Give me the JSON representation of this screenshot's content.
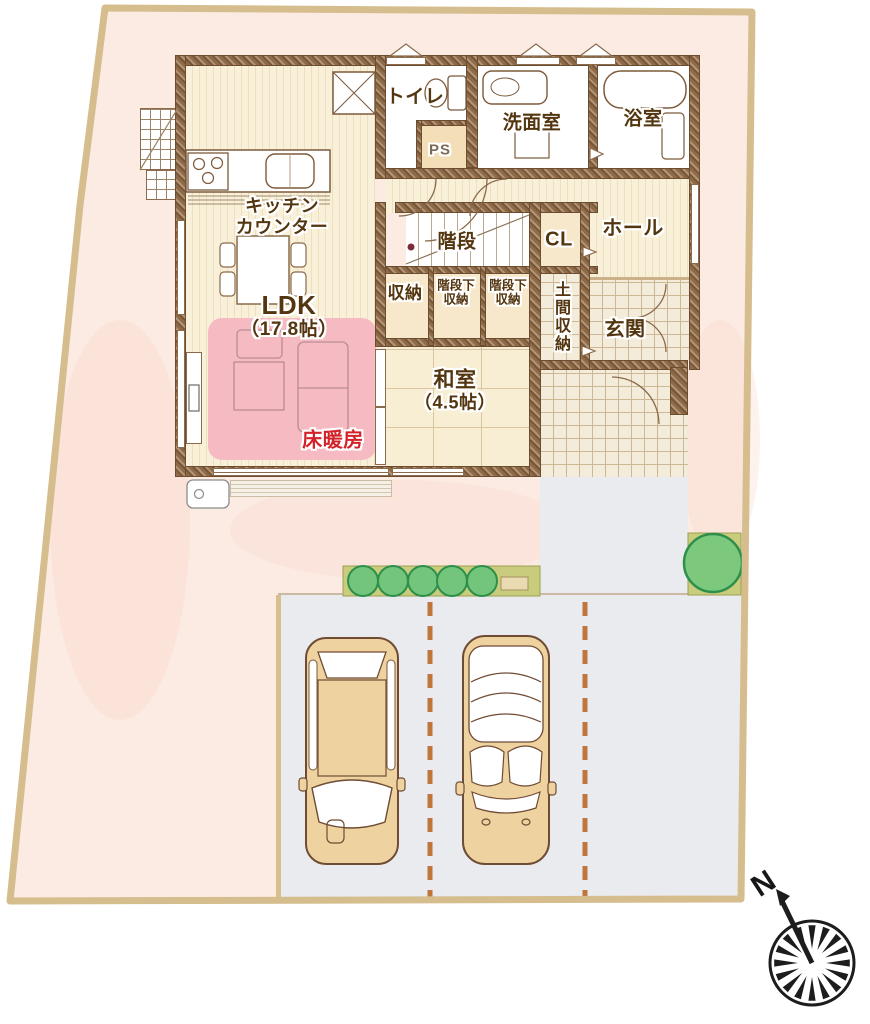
{
  "rooms": {
    "toilet": "トイレ",
    "ps": "PS",
    "washroom": "洗面室",
    "bathroom": "浴室",
    "hall": "ホール",
    "stairs": "階段",
    "closet": "CL",
    "kitchen": {
      "line1": "キッチン",
      "line2": "カウンター"
    },
    "storage": "収納",
    "under_stairs_left": {
      "line1": "階段下",
      "line2": "収納"
    },
    "under_stairs_right": {
      "line1": "階段下",
      "line2": "収納"
    },
    "doma_storage": "土間収納",
    "entrance": "玄関",
    "ldk": {
      "line1": "LDK",
      "line2": "（17.8帖）"
    },
    "japanese_room": {
      "line1": "和室",
      "line2": "（4.5帖）"
    },
    "floor_heating": "床暖房"
  },
  "compass": {
    "north": "N"
  },
  "colors": {
    "site_fill": "#fcebe3",
    "site_border": "#d6bd8e",
    "wall_brown": "#8f6a47",
    "floor_cream": "#f9f0da",
    "tatami": "#f7eed3",
    "tile": "#f3ecda",
    "heating_pink": "#f5bac2",
    "heating_label_red": "#d3232a",
    "label_brown": "#53350f",
    "pavement_gray": "#e9ebee",
    "planting_green": "#c9cc7c",
    "bush_green": "#72c57a",
    "car_body_tan": "#eed2a0",
    "parking_dash_orange": "#c0763a"
  }
}
